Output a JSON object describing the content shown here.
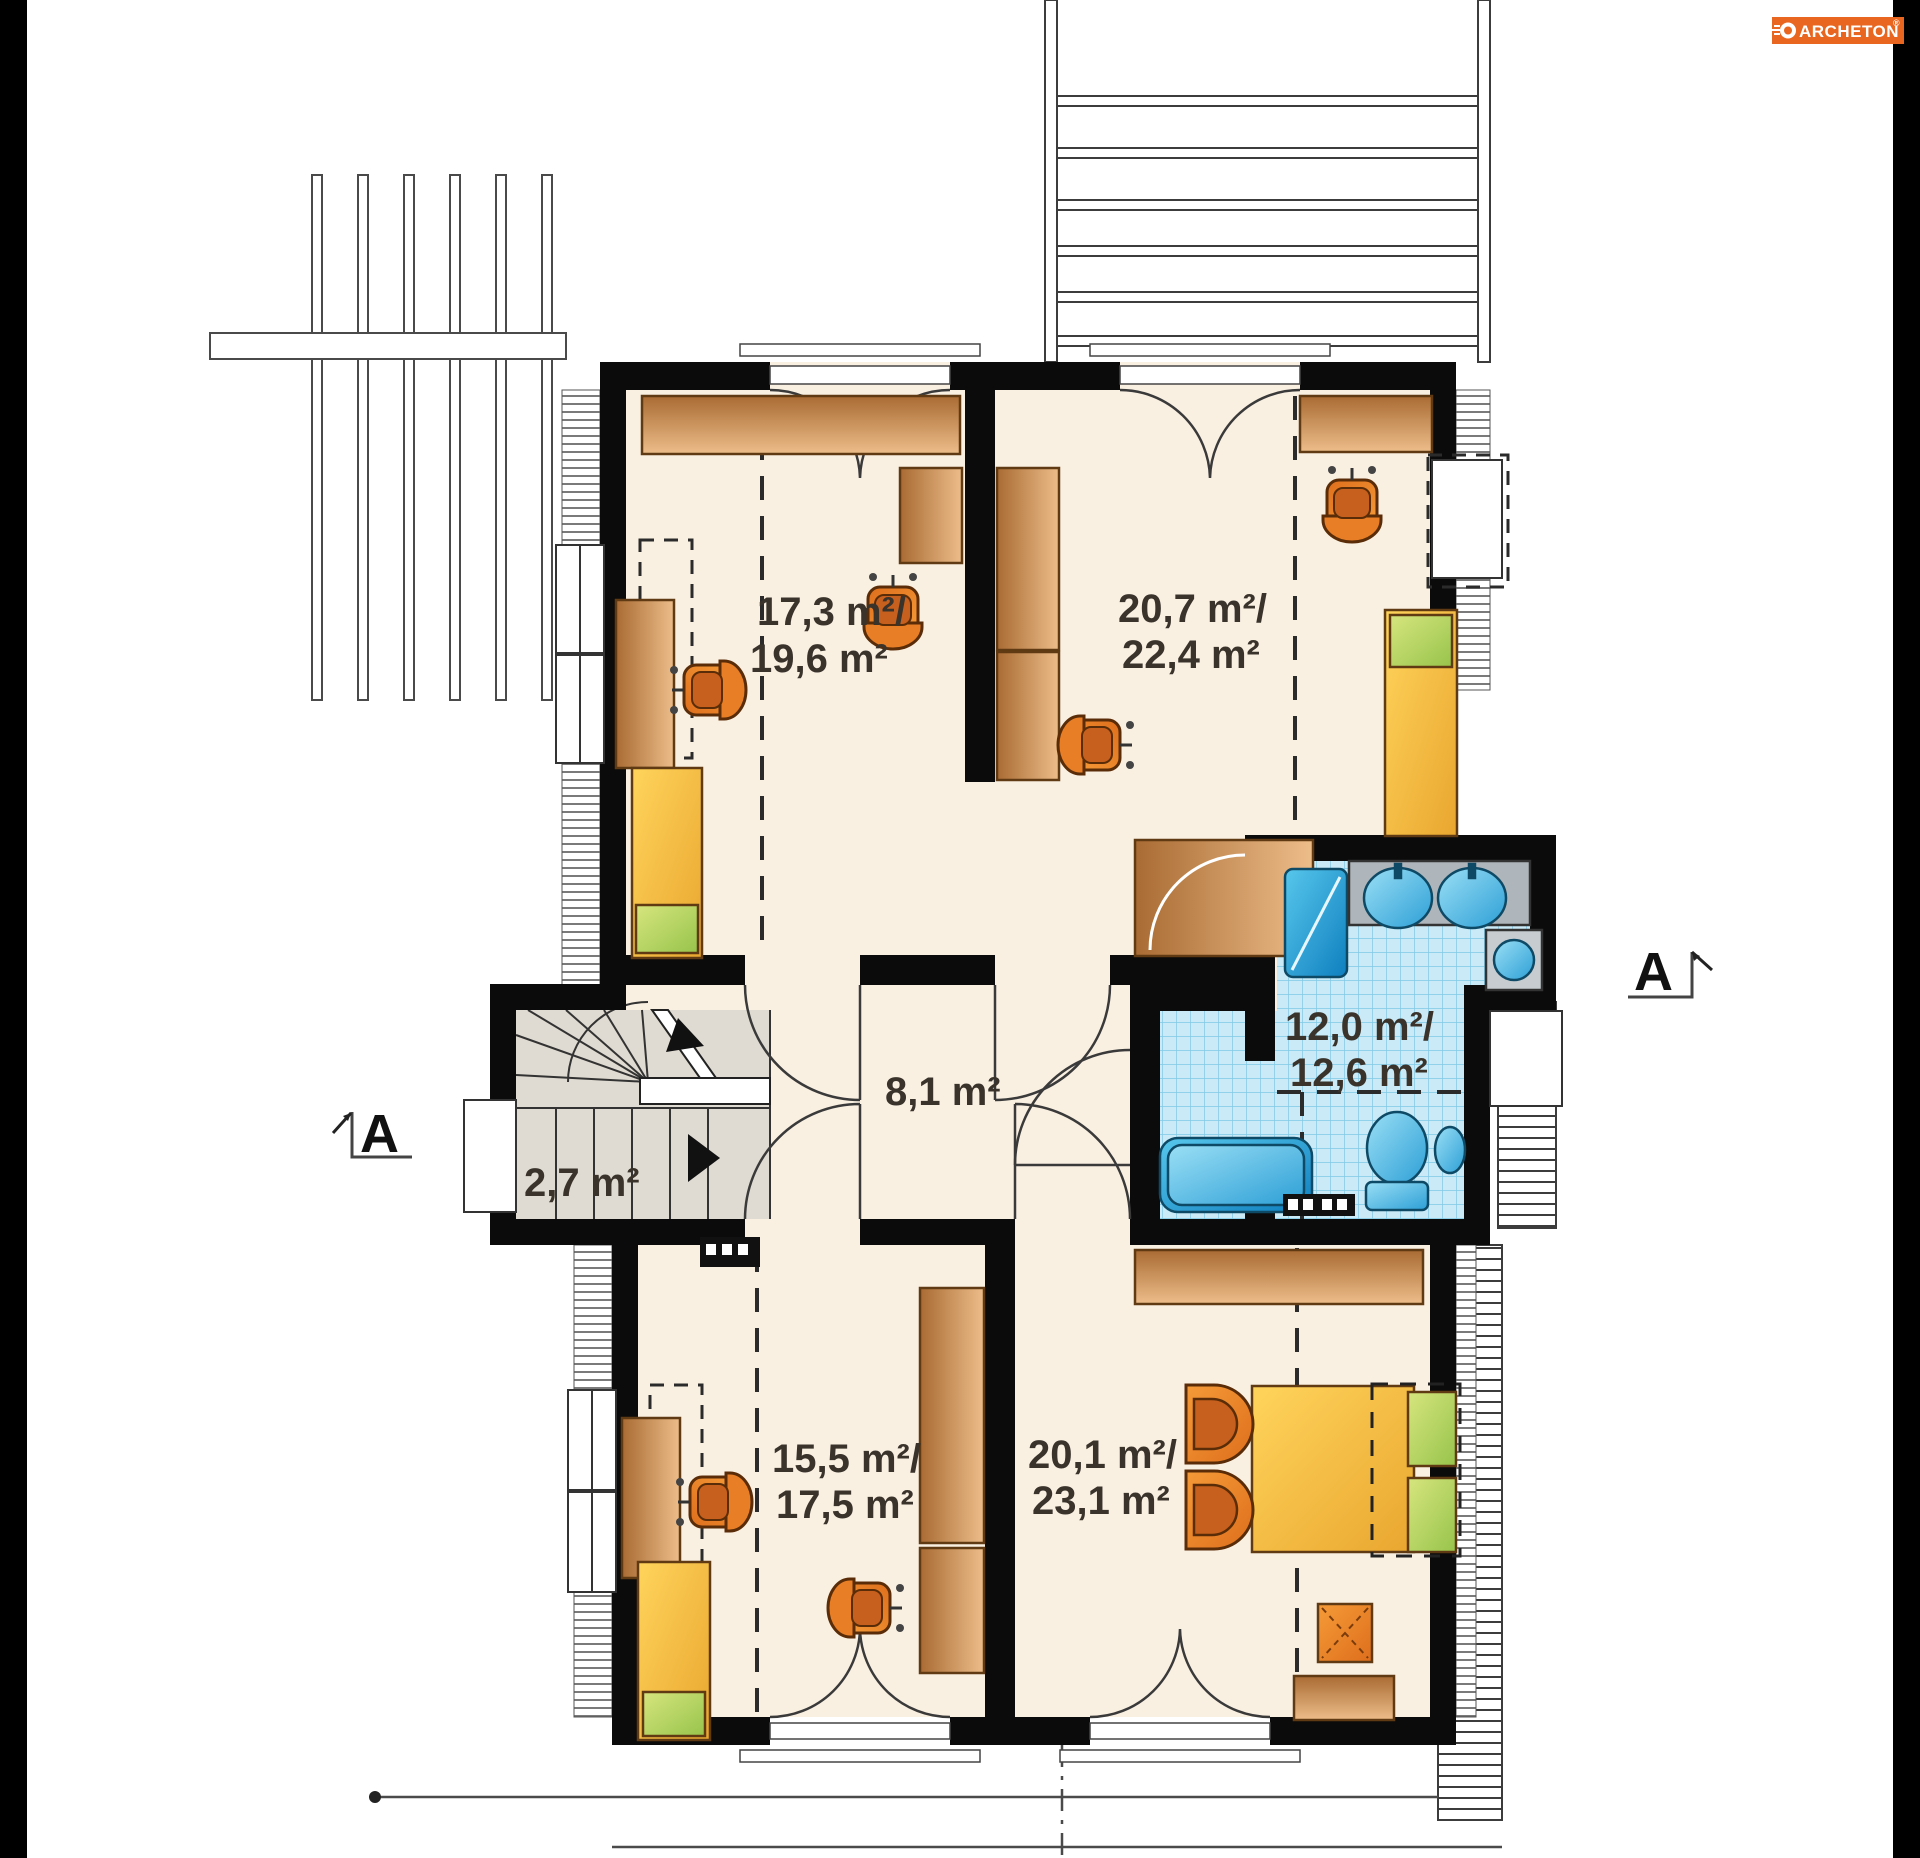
{
  "logo": {
    "brand": "ARCHETON",
    "registered": "®"
  },
  "section_markers": {
    "left": "A",
    "right": "A"
  },
  "rooms": [
    {
      "id": "bedroom-top-left",
      "line1": "17,3 m²/",
      "line2": "19,6 m²"
    },
    {
      "id": "bedroom-top-right",
      "line1": "20,7 m²/",
      "line2": "22,4 m²"
    },
    {
      "id": "bathroom",
      "line1": "12,0 m²/",
      "line2": "12,6 m²"
    },
    {
      "id": "hall",
      "line1": "8,1 m²",
      "line2": ""
    },
    {
      "id": "stair-closet",
      "line1": "2,7 m²",
      "line2": ""
    },
    {
      "id": "bedroom-bottom-left",
      "line1": "15,5 m²/",
      "line2": "17,5 m²"
    },
    {
      "id": "bedroom-bottom-right",
      "line1": "20,1 m²/",
      "line2": "23,1 m²"
    }
  ],
  "palette": {
    "floor_cream": "#FAF0E2",
    "wall_black": "#0B0B0B",
    "wood_brown": "#C98A4B",
    "furniture_orange": "#E87E26",
    "bed_yellow": "#F6BC3E",
    "pillow_green": "#B5D45E",
    "bath_fixture_blue": "#35A9DB",
    "tile_blue": "#C9EAF6",
    "stair_gray": "#E0DBD2",
    "logo_orange": "#E8661F",
    "label_text": "#39332B"
  }
}
